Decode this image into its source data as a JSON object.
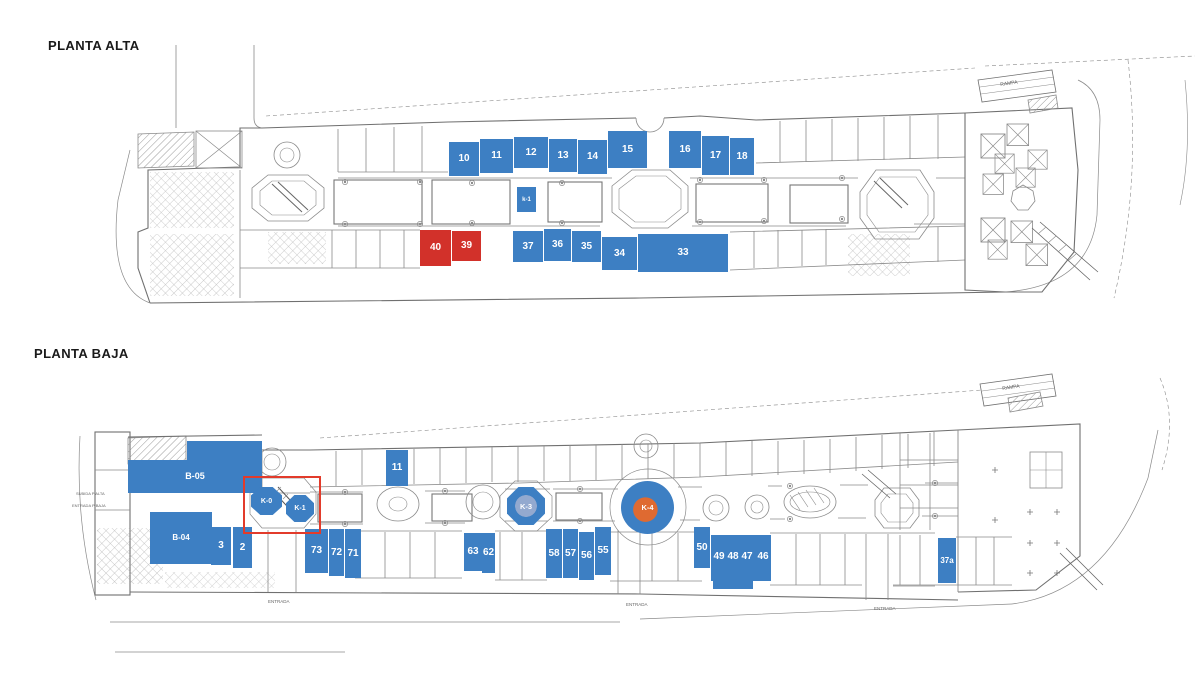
{
  "titles": {
    "planta_alta": "PLANTA ALTA",
    "planta_baja": "PLANTA BAJA"
  },
  "colors": {
    "highlight_blue": "#3d7fc3",
    "highlight_red": "#d2312a",
    "selection_box_red": "#e23b2b",
    "kiosk_center_orange": "#df6a31",
    "linework_gray": "#8a8a8a"
  },
  "planta_alta": {
    "ramp": "RAMPA",
    "units": [
      {
        "label": "10",
        "x": 449,
        "y": 142,
        "w": 30,
        "h": 34,
        "color": "blue"
      },
      {
        "label": "11",
        "x": 480,
        "y": 139,
        "w": 33,
        "h": 34,
        "color": "blue"
      },
      {
        "label": "12",
        "x": 514,
        "y": 137,
        "w": 34,
        "h": 31,
        "color": "blue"
      },
      {
        "label": "13",
        "x": 549,
        "y": 139,
        "w": 28,
        "h": 33,
        "color": "blue"
      },
      {
        "label": "14",
        "x": 578,
        "y": 140,
        "w": 29,
        "h": 34,
        "color": "blue"
      },
      {
        "label": "15",
        "x": 608,
        "y": 131,
        "w": 39,
        "h": 37,
        "color": "blue"
      },
      {
        "label": "16",
        "x": 669,
        "y": 131,
        "w": 32,
        "h": 37,
        "color": "blue"
      },
      {
        "label": "17",
        "x": 702,
        "y": 136,
        "w": 27,
        "h": 39,
        "color": "blue"
      },
      {
        "label": "18",
        "x": 730,
        "y": 138,
        "w": 24,
        "h": 37,
        "color": "blue"
      },
      {
        "label": "k-1",
        "x": 517,
        "y": 187,
        "w": 19,
        "h": 25,
        "color": "blue",
        "fs": 6
      },
      {
        "label": "40",
        "x": 420,
        "y": 230,
        "w": 31,
        "h": 36,
        "color": "red"
      },
      {
        "label": "39",
        "x": 452,
        "y": 231,
        "w": 29,
        "h": 30,
        "color": "red"
      },
      {
        "label": "37",
        "x": 513,
        "y": 231,
        "w": 30,
        "h": 31,
        "color": "blue"
      },
      {
        "label": "36",
        "x": 544,
        "y": 229,
        "w": 27,
        "h": 32,
        "color": "blue"
      },
      {
        "label": "35",
        "x": 572,
        "y": 231,
        "w": 29,
        "h": 31,
        "color": "blue"
      },
      {
        "label": "34",
        "x": 602,
        "y": 237,
        "w": 35,
        "h": 33,
        "color": "blue"
      },
      {
        "label": "33",
        "x": 638,
        "y": 234,
        "w": 90,
        "h": 38,
        "color": "blue"
      }
    ]
  },
  "planta_baja": {
    "ramp": "RAMPA",
    "kiosks": {
      "k0": "K-0",
      "k1": "K-1",
      "k3": "K-3",
      "k4": "K-4"
    },
    "entrances": [
      "ENTRADA",
      "ENTRADA",
      "ENTRADA"
    ],
    "side_labels": [
      "SUBIDA P ALTA",
      "ENTRADA P BAJA"
    ],
    "units": [
      {
        "label": "",
        "x": 187,
        "y": 441,
        "w": 75,
        "h": 21,
        "color": "blue"
      },
      {
        "label": "B-05",
        "x": 128,
        "y": 460,
        "w": 134,
        "h": 33,
        "color": "blue",
        "fs": 9
      },
      {
        "label": "B-04",
        "x": 150,
        "y": 512,
        "w": 62,
        "h": 52,
        "color": "blue",
        "fs": 8
      },
      {
        "label": "3",
        "x": 211,
        "y": 527,
        "w": 20,
        "h": 38,
        "color": "blue"
      },
      {
        "label": "2",
        "x": 233,
        "y": 527,
        "w": 19,
        "h": 41,
        "color": "blue"
      },
      {
        "label": "11",
        "x": 386,
        "y": 450,
        "w": 22,
        "h": 36,
        "color": "blue"
      },
      {
        "label": "73",
        "x": 305,
        "y": 529,
        "w": 23,
        "h": 44,
        "color": "blue"
      },
      {
        "label": "72",
        "x": 329,
        "y": 529,
        "w": 15,
        "h": 47,
        "color": "blue"
      },
      {
        "label": "71",
        "x": 345,
        "y": 529,
        "w": 16,
        "h": 49,
        "color": "blue"
      },
      {
        "label": "63",
        "x": 464,
        "y": 533,
        "w": 18,
        "h": 38,
        "color": "blue"
      },
      {
        "label": "62",
        "x": 482,
        "y": 533,
        "w": 13,
        "h": 40,
        "color": "blue"
      },
      {
        "label": "58",
        "x": 546,
        "y": 529,
        "w": 16,
        "h": 49,
        "color": "blue"
      },
      {
        "label": "57",
        "x": 563,
        "y": 529,
        "w": 15,
        "h": 49,
        "color": "blue"
      },
      {
        "label": "56",
        "x": 579,
        "y": 532,
        "w": 15,
        "h": 48,
        "color": "blue"
      },
      {
        "label": "55",
        "x": 595,
        "y": 527,
        "w": 16,
        "h": 48,
        "color": "blue"
      },
      {
        "label": "50",
        "x": 694,
        "y": 527,
        "w": 16,
        "h": 41,
        "color": "blue"
      },
      {
        "label": "",
        "x": 711,
        "y": 535,
        "w": 60,
        "h": 46,
        "color": "blue"
      },
      {
        "label": "",
        "x": 713,
        "y": 580,
        "w": 40,
        "h": 9,
        "color": "blue"
      },
      {
        "label": "49",
        "x": 712,
        "y": 549,
        "w": 14,
        "h": 16,
        "color": "none"
      },
      {
        "label": "48",
        "x": 726,
        "y": 549,
        "w": 14,
        "h": 16,
        "color": "none"
      },
      {
        "label": "47",
        "x": 740,
        "y": 549,
        "w": 14,
        "h": 16,
        "color": "none"
      },
      {
        "label": "46",
        "x": 756,
        "y": 549,
        "w": 14,
        "h": 16,
        "color": "none"
      },
      {
        "label": "37a",
        "x": 938,
        "y": 538,
        "w": 18,
        "h": 45,
        "color": "blue",
        "fs": 8
      }
    ]
  }
}
